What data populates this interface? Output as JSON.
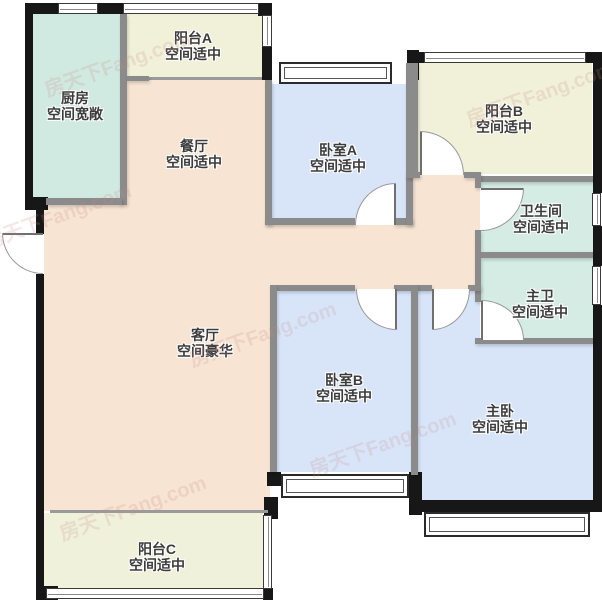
{
  "plan": {
    "title": "户型图",
    "watermark": "房天下Fang.com",
    "rooms": [
      {
        "id": "kitchen",
        "name": "厨房",
        "desc": "空间宽敞"
      },
      {
        "id": "balcony-a",
        "name": "阳台A",
        "desc": "空间适中"
      },
      {
        "id": "dining",
        "name": "餐厅",
        "desc": "空间适中"
      },
      {
        "id": "bedroom-a",
        "name": "卧室A",
        "desc": "空间适中"
      },
      {
        "id": "balcony-b",
        "name": "阳台B",
        "desc": "空间适中"
      },
      {
        "id": "bathroom",
        "name": "卫生间",
        "desc": "空间适中"
      },
      {
        "id": "master-bath",
        "name": "主卫",
        "desc": "空间适中"
      },
      {
        "id": "living",
        "name": "客厅",
        "desc": "空间豪华"
      },
      {
        "id": "bedroom-b",
        "name": "卧室B",
        "desc": "空间适中"
      },
      {
        "id": "master-bedroom",
        "name": "主卧",
        "desc": "空间适中"
      },
      {
        "id": "balcony-c",
        "name": "阳台C",
        "desc": "空间适中"
      }
    ],
    "colors": {
      "kitchen": "#d0e9e1",
      "bathroom": "#d4ece4",
      "balcony": "#f1f0d9",
      "balcony_c": "#eff1db",
      "living_dining": "#f7e4d3",
      "bedroom": "#d8e5f9",
      "exterior_wall": "#171717",
      "interior_wall": "#8b8b8b"
    }
  }
}
